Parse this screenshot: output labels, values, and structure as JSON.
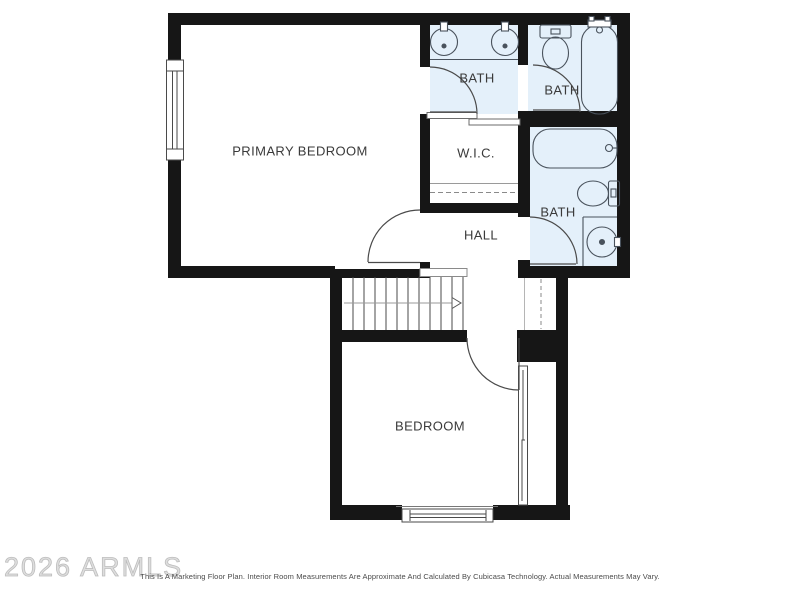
{
  "watermark": "2026 ARMLS",
  "disclaimer": "This Is A Marketing Floor Plan. Interior Room Measurements Are Approximate And Calculated By Cubicasa Technology. Actual Measurements May Vary.",
  "rooms": {
    "primary_bedroom": {
      "label": "PRIMARY BEDROOM"
    },
    "bath_ensuite": {
      "label": "BATH"
    },
    "bath_top_right": {
      "label": "BATH"
    },
    "wic": {
      "label": "W.I.C."
    },
    "bath_hall": {
      "label": "BATH"
    },
    "hall": {
      "label": "HALL"
    },
    "bedroom": {
      "label": "BEDROOM"
    }
  },
  "icons": {
    "sink": "round-basin-with-faucet",
    "toilet": "tank-and-bowl-plan-symbol",
    "bathtub": "tub-plan-symbol",
    "door": "quarter-circle-swing-arc",
    "sliding_door": "offset-track-bars",
    "window": "double-line-in-wall",
    "stairs": "treads-with-direction-arrow",
    "closet_rod": "dashed-line"
  },
  "colors": {
    "wall": "#161616",
    "bath_fill": "#e4f0fa",
    "fixture_line": "#49525c",
    "door_line": "#4a4a4a",
    "label_text": "#3a3a3a",
    "watermark": "#bdbdbd",
    "disclaimer_text": "#4a4a4a"
  }
}
